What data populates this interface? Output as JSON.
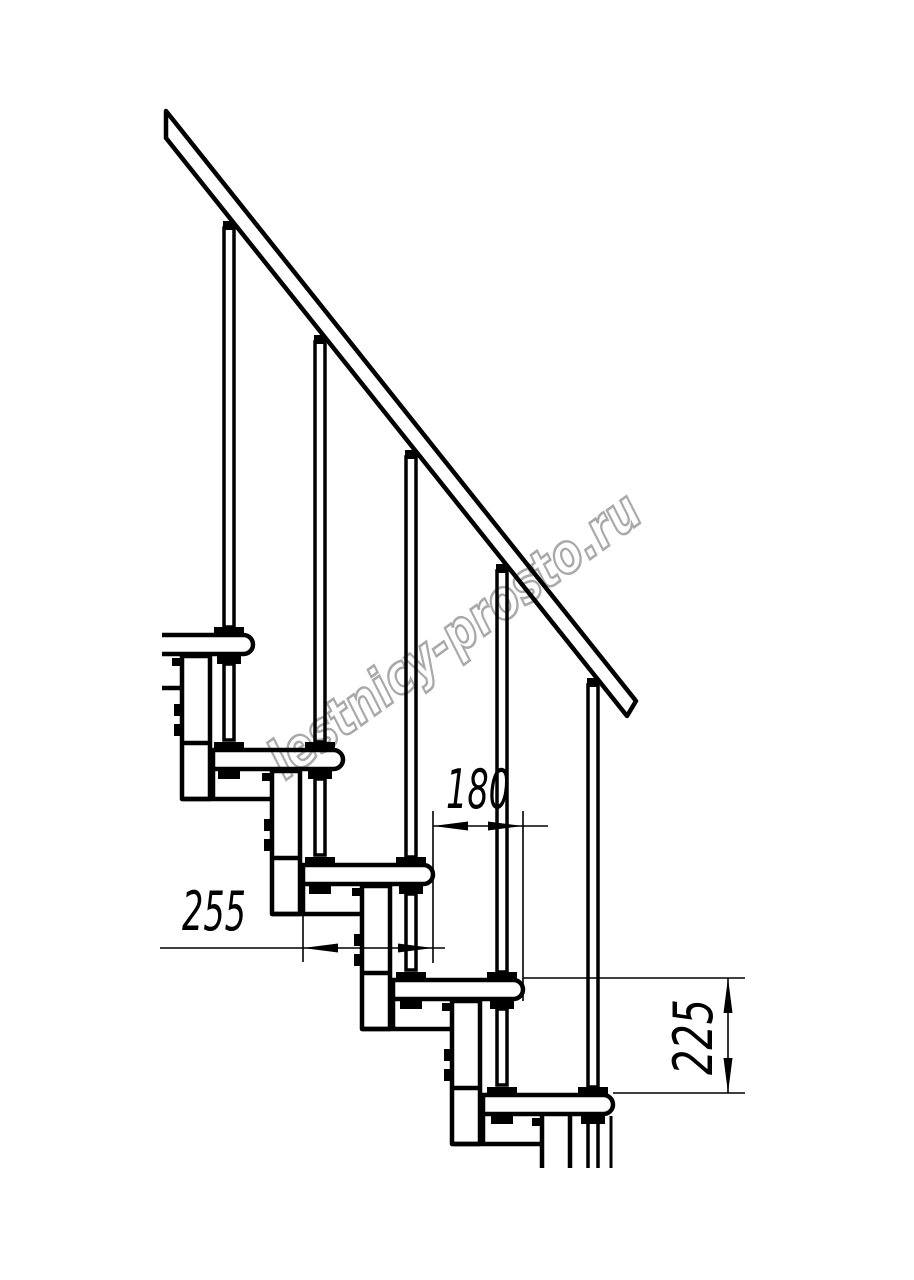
{
  "watermark": {
    "text": "lestnicy-prosto.ru",
    "color": "#a9a9a9"
  },
  "colors": {
    "line": "#000000",
    "background": "#ffffff"
  },
  "dimensions": {
    "run": {
      "label": "180"
    },
    "depth": {
      "label": "255"
    },
    "rise": {
      "label": "225"
    }
  }
}
